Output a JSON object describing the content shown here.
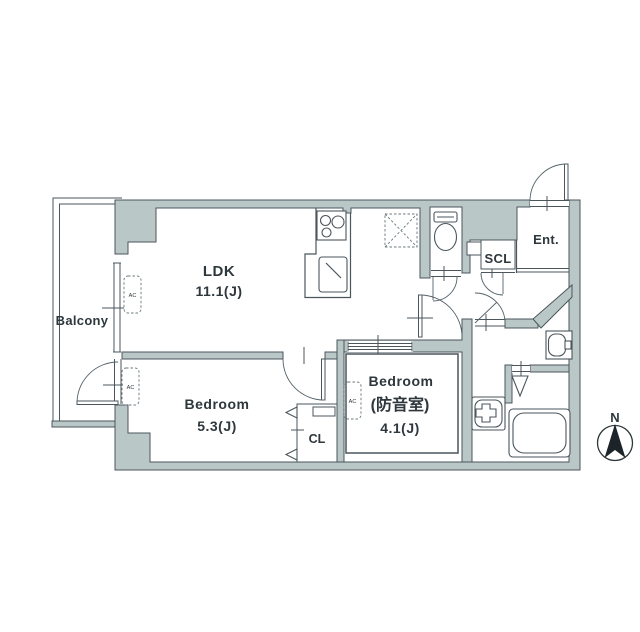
{
  "floorplan": {
    "rooms": {
      "ldk": {
        "name": "LDK",
        "area": "11.1(J)"
      },
      "bedroom": {
        "name": "Bedroom",
        "area": "5.3(J)"
      },
      "soundproof_bedroom": {
        "name": "Bedroom",
        "subtitle": "(防音室)",
        "area": "4.1(J)"
      },
      "balcony": {
        "name": "Balcony"
      },
      "closet": {
        "name": "CL"
      },
      "shoe_closet": {
        "name": "SCL"
      },
      "entrance": {
        "name": "Ent."
      }
    },
    "labels": {
      "ac_unit": "AC",
      "compass_north": "N"
    },
    "colors": {
      "wall_fill": "#b9c7c7",
      "line": "#4a565c",
      "text": "#2e373c",
      "north_arrow": "#1c2429"
    }
  }
}
